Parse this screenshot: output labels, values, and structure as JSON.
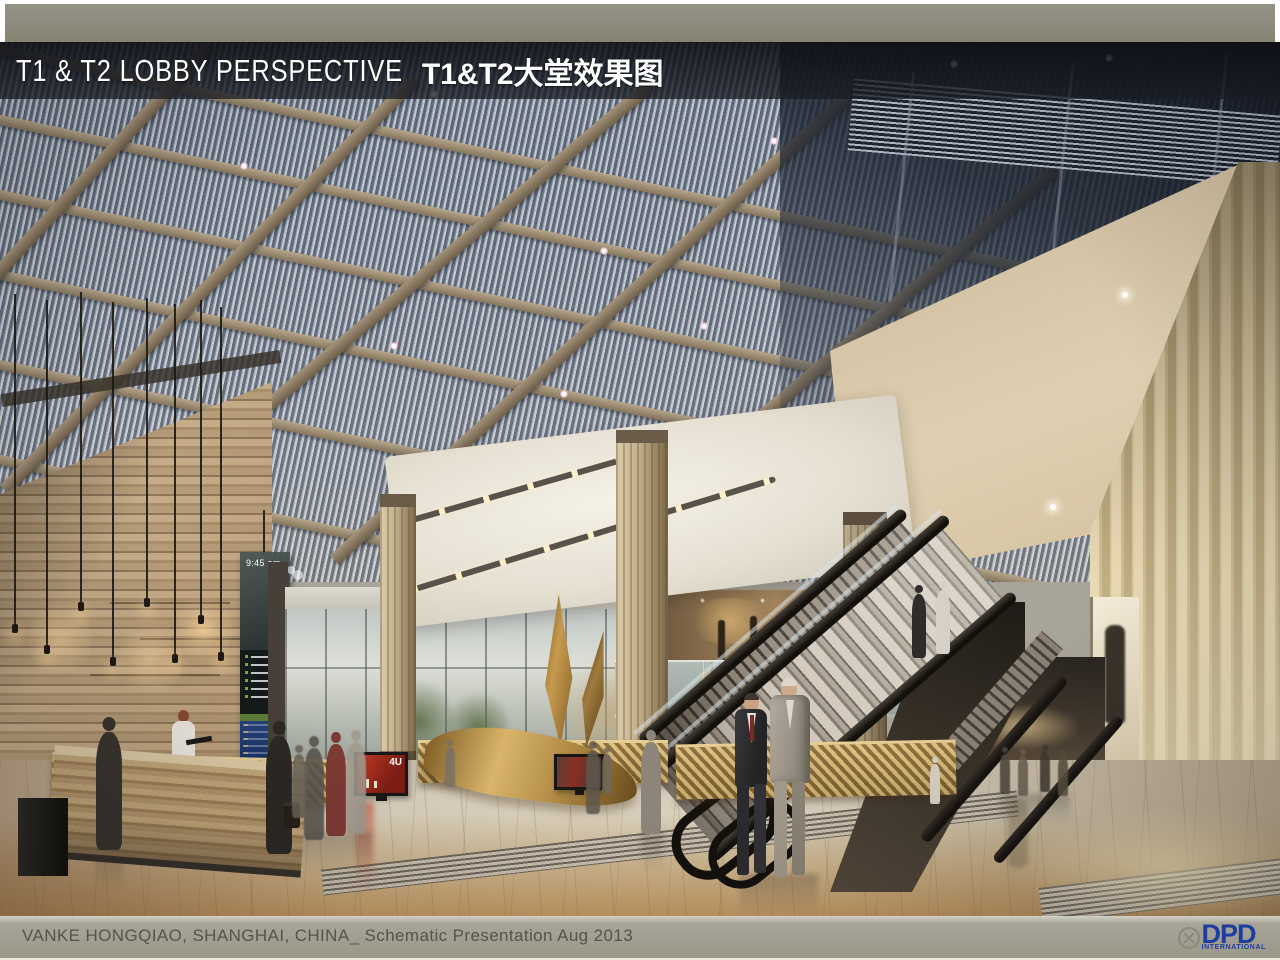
{
  "slide": {
    "header": {
      "title_en": "T1 & T2 LOBBY PERSPECTIVE",
      "title_zh": "T1&T2大堂效果图"
    },
    "footer": {
      "caption": "VANKE HONGQIAO, SHANGHAI, CHINA_ Schematic Presentation Aug 2013",
      "logo": {
        "text": "DPD",
        "subtitle": "INTERNATIONAL",
        "icon": "crossed-circle-icon",
        "color": "#1d3e9e"
      }
    },
    "rendering": {
      "description": "Architectural rendering of the T1 & T2 lobby: louvered skylight coffer ceiling, travertine feature wall with reception desk and pendant lamps, hanging flight-information totem, gold sculpture, luxury car showcase, escalators and stair to mezzanine, vertical timber-slat wall, people crossing a polished wood floor",
      "flight_board_time": "9:45 am",
      "screen_label": "4U"
    },
    "palette": {
      "top_bar_gray": "#8d8b7e",
      "title_band": "rgba(14,16,22,0.85)",
      "footer_bar": "#9b9889",
      "footer_text": "#55534a",
      "dpd_blue": "#1d3e9e",
      "ceiling_blue_gray": "#97a0ae",
      "beam_tan": "#a5947c",
      "travertine": "#b29a79",
      "timber_wall": "#d8c79f",
      "floor_wood": "#c49a64",
      "sculpture_gold": "#c79a4e",
      "screen_red": "#c23a28"
    }
  }
}
